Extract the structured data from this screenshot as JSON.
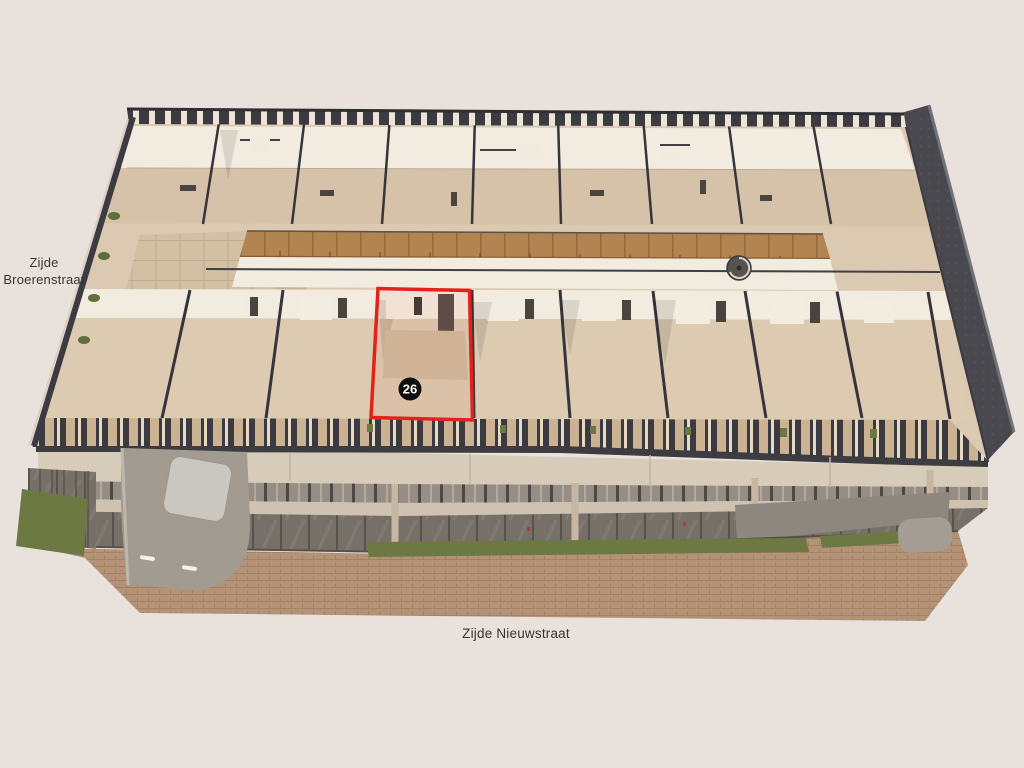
{
  "labels": {
    "left_street_line1": "Zijde",
    "left_street_line2": "Broerenstraat",
    "bottom_street": "Zijde Nieuwstraat"
  },
  "unit": {
    "number": "26",
    "outline_color": "#e3231b",
    "badge_background": "#0f0f0f",
    "badge_text_color": "#ffffff"
  },
  "colors": {
    "background": "#e9e2dc",
    "floor_base": "#dbc9b2",
    "wall_white": "#f2ebdf",
    "cut_wall_dark": "#3a3a40",
    "wood_deck": "#b18452",
    "grass": "#6d7943",
    "pavement": "#b49278",
    "facade": "#d7cbba",
    "tower": "#a29b92",
    "right_wall": "#48484e"
  }
}
